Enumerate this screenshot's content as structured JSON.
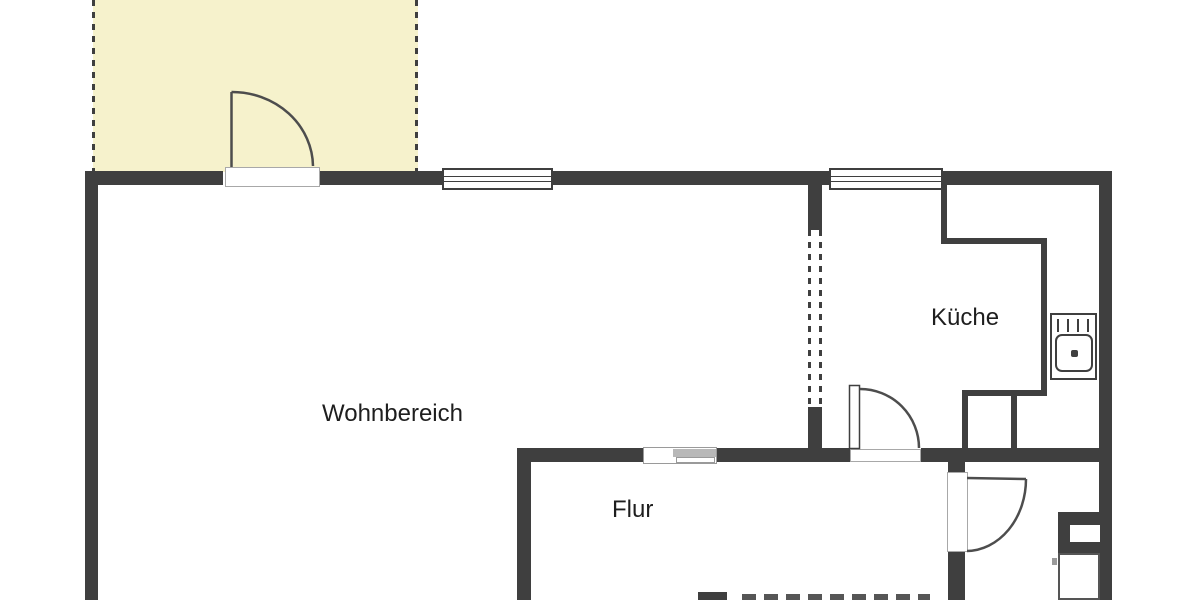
{
  "plan": {
    "type": "apartment-floor-plan",
    "rooms": [
      {
        "id": "wohnbereich",
        "label": "Wohnbereich"
      },
      {
        "id": "kueche",
        "label": "Küche"
      },
      {
        "id": "flur",
        "label": "Flur"
      }
    ],
    "unlabeled_areas": [
      "balcony",
      "bathroom"
    ],
    "fixtures": [
      "balcony-door",
      "living-room-window",
      "kitchen-window",
      "kitchen-counter",
      "kitchen-sink",
      "kitchen-door",
      "sliding-door",
      "bathroom-door",
      "duct-shaft",
      "bathroom-fixture"
    ],
    "colors": {
      "wall": "#3f3f3f",
      "balcony_fill": "#f6f2cc",
      "label_text": "#1e1e1e",
      "threshold_border": "#a8a8a8",
      "sliding_door_gray": "#b8b8b8",
      "bottom_dash_gray": "#565656",
      "background": "#ffffff"
    }
  }
}
